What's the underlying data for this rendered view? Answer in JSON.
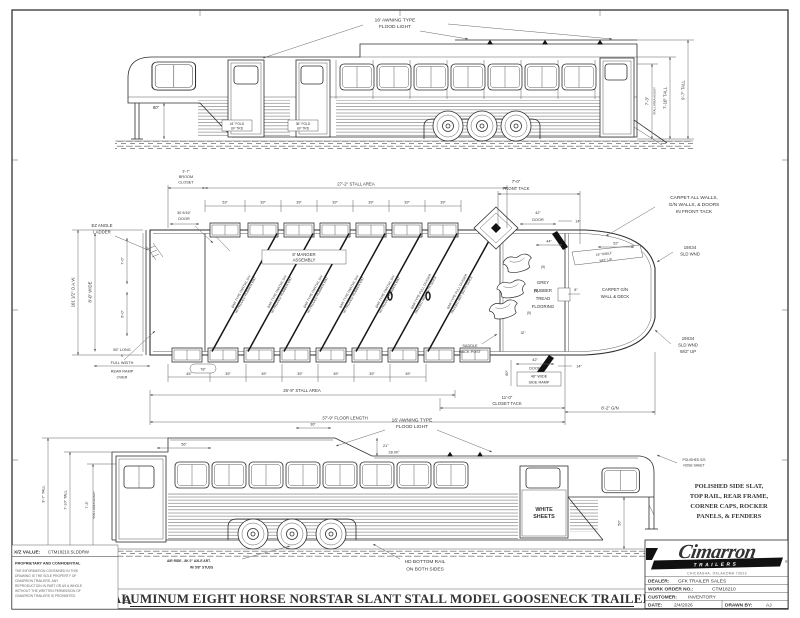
{
  "sheet": {
    "title": "ALUMINUM EIGHT HORSE NORSTAR SLANT STALL MODEL GOOSENECK TRAILER",
    "revision": "A"
  },
  "top_view": {
    "awning": [
      "16' AWNING TYPE",
      "FLOOD LIGHT"
    ],
    "fold_44": [
      "44\" FOLD",
      "UP TRD"
    ],
    "fold_36": [
      "36\" FOLD",
      "UP TRD"
    ],
    "dim_80": "80\"",
    "stall_height": [
      "7'-3\"",
      "STALL AREA HEIGHT"
    ],
    "tall_710": "7'-10\" TALL",
    "tall_97": "9'-7\" TALL"
  },
  "plan_view": {
    "broom": [
      "3'-7\"",
      "BROOM",
      "CLOSET"
    ],
    "stall_area_top": "27'-2\" STALL AREA",
    "top_dims": [
      "53\"",
      "39\"",
      "39\"",
      "39\"",
      "39\"",
      "39\"",
      "39\""
    ],
    "door_small": [
      "30 9/16\"",
      "DOOR"
    ],
    "ladder": [
      "EZ ANGLE",
      "LADDER"
    ],
    "oaw": "101 1/2\" O.A.W.",
    "wide": "8'-0\" WIDE",
    "dim_70": "7'-0\"",
    "dim_60": "6'-0\"",
    "manger": [
      "8' MANGER",
      "ASSEMBLY"
    ],
    "front_tack": [
      "7'-0\"",
      "FRONT TACK"
    ],
    "carpet_note": [
      "CARPET ALL WALLS,",
      "G/N WALLS, & DOORS",
      "IN FRONT TACK"
    ],
    "sld_wnd_top": [
      "19X34",
      "SLD WND"
    ],
    "sld_wnd_bottom": [
      "19X34",
      "SLD WND",
      "W/2\" UP"
    ],
    "shelf": [
      "18\" SHELF",
      "W/2\" LIP"
    ],
    "carpet_gn": [
      "CARPET G/N",
      "WALL & DECK"
    ],
    "flooring": [
      "GREY",
      "RUBBER",
      "TREAD",
      "FLOORING"
    ],
    "saddle_post": [
      "SADDLE",
      "RACK POST"
    ],
    "saddle_qty": "(5)",
    "door_42_top": [
      "42\"",
      "DOOR"
    ],
    "dim_44": "44\"",
    "dim_14_top": "14\"",
    "dim_52": "52\"",
    "dim_8": "8\"",
    "door_42_bottom": [
      "42\"",
      "DOOR"
    ],
    "side_ramp": [
      "48\" WIDE",
      "SIDE RAMP"
    ],
    "dim_60_ramp": "60\"",
    "dim_14_bottom": "14\"",
    "dim_32": "32\"",
    "closet_tack": [
      "11'-0\"",
      "CLOSET TACK"
    ],
    "gn_len": "8'-2\" G/N",
    "ramp_over": [
      "55\" LONG",
      "X",
      "FULL WIDTH",
      "REAR RAMP",
      "OVER"
    ],
    "oval_78": "78\"",
    "bottom_dims": [
      "45\"",
      "39\"",
      "39\"",
      "39\"",
      "39\"",
      "39\"",
      "39\""
    ],
    "stall_area_bottom": "26'-9\" STALL AREA",
    "floor_length": "37'-9\" FLOOR LENGTH",
    "divider_partial": [
      "BAR TYPE PARTIAL DIV",
      "W/ PADDED RUBBER MAT"
    ],
    "divider_full": [
      "BAR TYPE FULL DIVIDER",
      "PADDED MAT BOTH SIDES"
    ]
  },
  "bottom_view": {
    "awning": [
      "16' AWNING TYPE",
      "FLOOD LIGHT"
    ],
    "dim_36": "36\"",
    "dim_56": "56\"",
    "angle": "28.00°",
    "dim_21": "21\"",
    "dim_50": "50\"",
    "white_sheets": [
      "WHITE",
      "SHEETS"
    ],
    "nose_sheet": [
      "POLISHED S/S",
      "NOSE SHEET"
    ],
    "polished_note": [
      "POLISHED SIDE SLAT,",
      "TOP RAIL, REAR FRAME,",
      "CORNER CAPS, ROCKER",
      "PANELS, & FENDERS"
    ],
    "air_ride": [
      "AIR RIDE - 8K 0\" AXLE ART.",
      "W/ 5/8\" STUDS"
    ],
    "hd_rail": [
      "HD BOTTOM RAIL",
      "ON BOTH SIDES"
    ],
    "tall_97": "9'-7\" TALL",
    "tall_710": "7'-10\" TALL",
    "stall_height": [
      "7'-3\"",
      "STALL AREA HEIGHT"
    ]
  },
  "title_block": {
    "brand": "Cimarron",
    "brand_sub": "TRAILERS",
    "reg": "®",
    "address": "CHICKASHA, OKLAHOMA 73023",
    "dealer_label": "DEALER:",
    "dealer_value": "GFK TRAILER SALES",
    "wo_label": "WORK ORDER NO.:",
    "wo_value": "CTM18210",
    "cust_label": "CUSTOMER:",
    "cust_value": "INVENTORY",
    "date_label": "DATE:",
    "date_value": "2/4/2026",
    "drawn_label": "DRAWN BY:",
    "drawn_value": "AJ"
  },
  "proprietary": {
    "xz_label": "X/Z VALUE:",
    "xz_value": "CTM18210.SLDDRW",
    "heading": "PROPRIETARY AND CONFIDENTIAL",
    "lines": [
      "THE INFORMATION CONTAINED IN THIS",
      "DRAWING IS THE SOLE PROPERTY OF",
      "CIMARRON TRAILERS.  ANY",
      "REPRODUCTION IN PART OR AS A WHOLE",
      "WITHOUT THE WRITTEN PERMISSION OF",
      "CIMARRON TRAILERS IS PROHIBITED."
    ]
  }
}
